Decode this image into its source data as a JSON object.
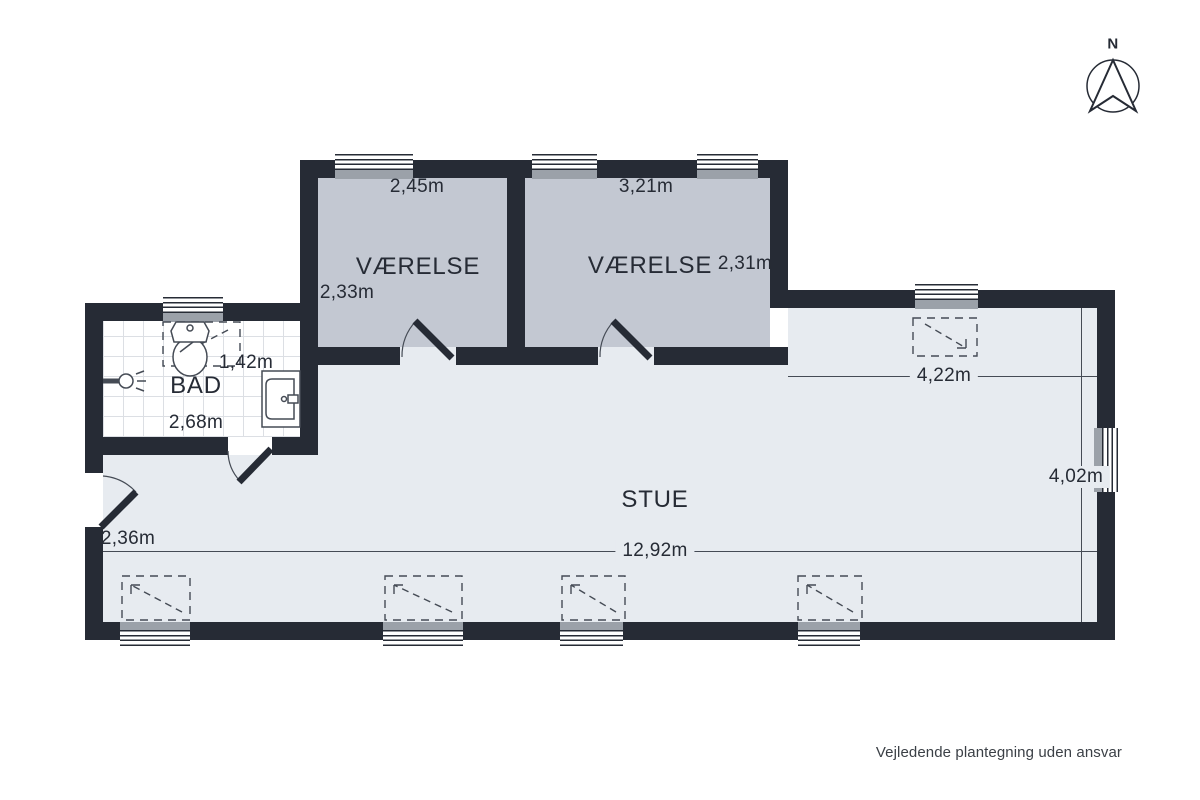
{
  "rooms": {
    "vaerelse1": {
      "label": "VÆRELSE",
      "width": "2,45m",
      "depth": "2,33m"
    },
    "vaerelse2": {
      "label": "VÆRELSE",
      "width": "3,21m",
      "depth": "2,31m"
    },
    "bad": {
      "label": "BAD",
      "width": "2,68m",
      "depth": "1,42m"
    },
    "stue": {
      "label": "STUE",
      "total_width": "12,92m",
      "right_width": "4,22m",
      "right_depth": "4,02m",
      "entry_depth": "2,36m"
    }
  },
  "compass": {
    "label": "N"
  },
  "footer": {
    "disclaimer": "Vejledende plantegning uden ansvar"
  },
  "colors": {
    "wall": "#262b35",
    "room-floor": "#c3c8d2",
    "stue-floor": "#e7ebf0",
    "bath-floor": "#ffffff",
    "tile-line": "#dcdfe4",
    "sill": "#9ba1a9",
    "dim-line": "#454b55",
    "text": "#262b35",
    "symbol": "#454b55"
  }
}
